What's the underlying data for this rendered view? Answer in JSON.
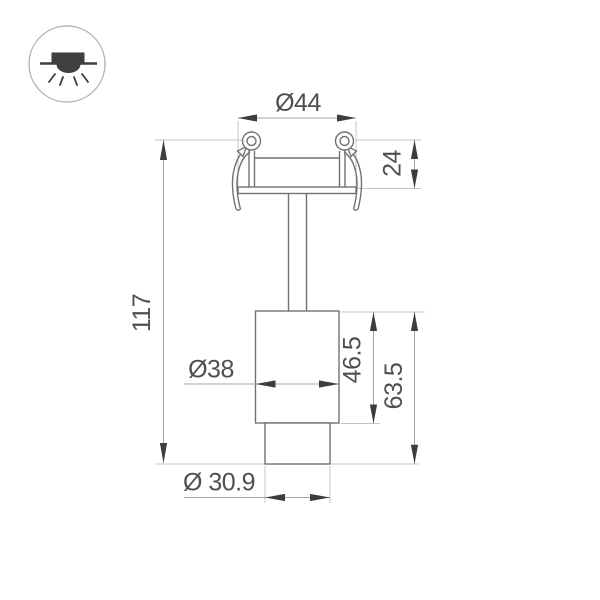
{
  "page": {
    "background": "#ffffff",
    "content_type": "technical dimension drawing of a recessed spotlight"
  },
  "icon": {
    "name": "recessed-downlight-icon"
  },
  "drawing": {
    "dimensions": {
      "trim_diameter": "Ø44",
      "recess_depth": "24",
      "overall_height": "117",
      "body_diameter": "Ø38",
      "body_height": "46.5",
      "head_height": "63.5",
      "tip_diameter": "Ø 30.9"
    },
    "colors": {
      "outline": "#717171",
      "dimension_line": "#a6a6a6",
      "extension_line": "#c4c4c4",
      "arrow": "#3d3d3d",
      "text": "#4f4f4f",
      "icon_symbol": "#3f3f3f",
      "icon_circle": "#ababab"
    }
  }
}
